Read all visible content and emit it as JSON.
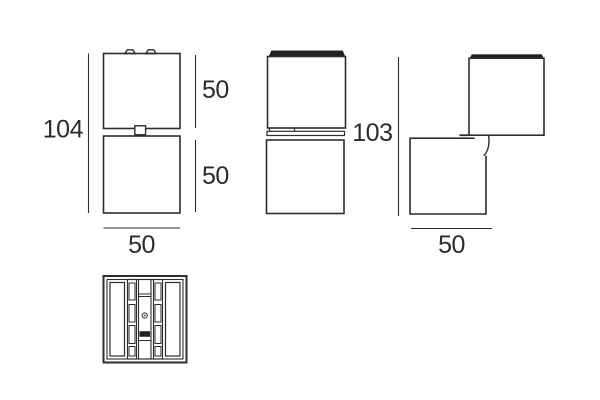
{
  "drawing": {
    "views": [
      {
        "name": "front-elevation",
        "labels": {
          "total_height": "104",
          "upper_height": "50",
          "lower_height": "50",
          "width": "50"
        }
      },
      {
        "name": "side-elevation",
        "labels": {}
      },
      {
        "name": "rotated-elevation",
        "labels": {
          "total_height": "103",
          "width": "50"
        }
      },
      {
        "name": "plan-view",
        "labels": {}
      }
    ],
    "colors": {
      "line": "#2d2d2d",
      "dark_fill": "#1f1f1f",
      "text": "#2b2b2b",
      "background": "#ffffff"
    }
  }
}
